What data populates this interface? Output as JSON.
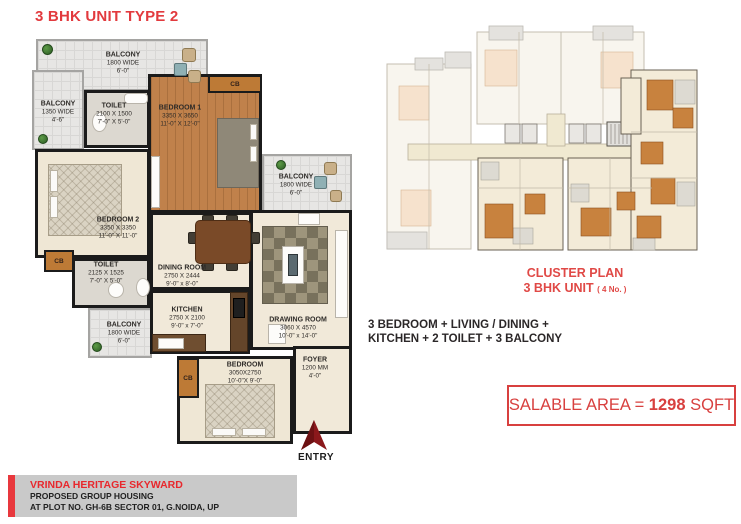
{
  "page": {
    "title": "3 BHK UNIT TYPE 2"
  },
  "floor_plan": {
    "rooms": [
      {
        "label": "BALCONY",
        "dim1": "1800 WIDE",
        "dim2": "6'-0\""
      },
      {
        "label": "BALCONY",
        "dim1": "1350 WIDE",
        "dim2": "4'-6\""
      },
      {
        "label": "TOILET",
        "dim1": "2100 X 1500",
        "dim2": "7'-0\" X 5'-0\""
      },
      {
        "label": "BEDROOM 1",
        "dim1": "3350 X 3650",
        "dim2": "11'-0\" X 12'-0\""
      },
      {
        "label": "BALCONY",
        "dim1": "1800 WIDE",
        "dim2": "6'-0\""
      },
      {
        "label": "BEDROOM 2",
        "dim1": "3350 X 3350",
        "dim2": "11'-0\" X  11'-0\""
      },
      {
        "label": "TOILET",
        "dim1": "2125 X 1525",
        "dim2": "7'-0\" X 5'-0\""
      },
      {
        "label": "DINING ROOM",
        "dim1": "2750 X 2444",
        "dim2": "9'-0\" x 8'-0\""
      },
      {
        "label": "KITCHEN",
        "dim1": "2750 X 2100",
        "dim2": "9'-0\" x 7'-0\""
      },
      {
        "label": "BALCONY",
        "dim1": "1800 WIDE",
        "dim2": "6'-0\""
      },
      {
        "label": "DRAWING ROOM",
        "dim1": "3060 X 4570",
        "dim2": "10'-0\" x 14'-0\""
      },
      {
        "label": "BEDROOM",
        "dim1": "3050X2750",
        "dim2": "10'-0\"X 9'-0\""
      },
      {
        "label": "FOYER",
        "dim1": "1200 MM",
        "dim2": "4'-0\""
      }
    ],
    "cupboard_label": "CB",
    "entry_label": "ENTRY"
  },
  "cluster": {
    "title_line1": "CLUSTER PLAN",
    "title_line2": "3 BHK UNIT",
    "title_line2_note": "( 4 No. )"
  },
  "summary": {
    "line1": "3 BEDROOM + LIVING / DINING +",
    "line2": "KITCHEN + 2 TOILET + 3 BALCONY"
  },
  "salable_area": {
    "prefix": "SALABLE AREA = ",
    "value": "1298",
    "suffix": " SQFT"
  },
  "footer": {
    "line1": "VRINDA HERITAGE SKYWARD",
    "line2": "PROPOSED GROUP HOUSING",
    "line3": "AT PLOT NO. GH-6B SECTOR 01, G.NOIDA, UP"
  },
  "colors": {
    "accent_red": "#e23a3e",
    "wall_black": "#1b1b1b",
    "wood_floor": "#c0814b",
    "cream_floor": "#efe7d5",
    "tile_gray": "#e7e6e4",
    "cupboard_orange": "#bd7a36",
    "cluster_highlight": "#c8823e",
    "footer_gray": "#c9c9c9"
  }
}
